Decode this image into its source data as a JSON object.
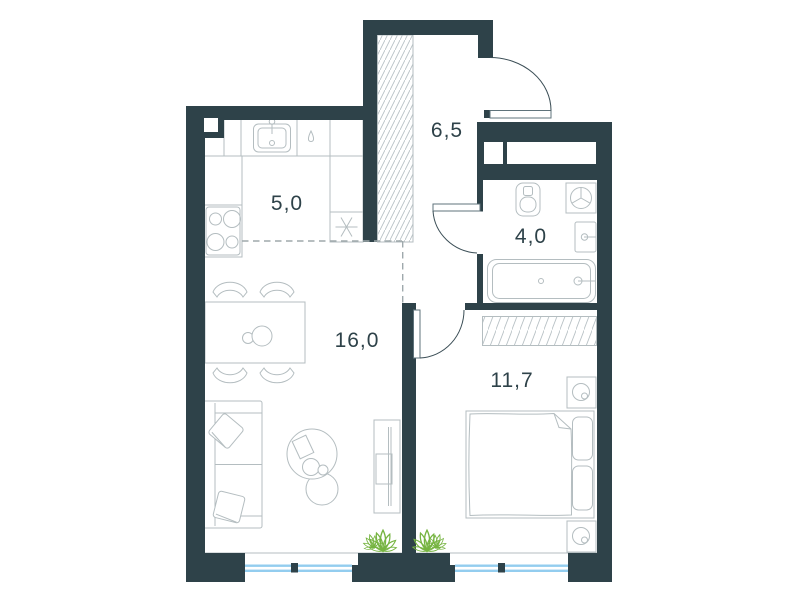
{
  "page": {
    "type": "apartment-floor-plan",
    "background": "#ffffff"
  },
  "rooms": [
    {
      "name": "kitchen",
      "area_label": "5,0"
    },
    {
      "name": "hallway",
      "area_label": "6,5"
    },
    {
      "name": "bathroom",
      "area_label": "4,0"
    },
    {
      "name": "living-room",
      "area_label": "16,0"
    },
    {
      "name": "bedroom",
      "area_label": "11,7"
    }
  ],
  "colors": {
    "wall": "#2e4249",
    "fixture_line": "#b4bdc0",
    "door_line": "#5f737b",
    "door_arc": "#3a4d55",
    "dashed_zone_line": "#9fa9ac",
    "window_glass": "#93cdef",
    "plant_green": "#76b441",
    "label_text": "#2e4249"
  },
  "icons": [
    "kitchen-sink-icon",
    "dishwasher-drop-icon",
    "fridge-snowflake-icon",
    "stove-icon",
    "ventilation-shaft-hatch",
    "toilet-icon",
    "washing-machine-icon",
    "bathroom-sink-icon",
    "bathtub-icon",
    "wardrobe-hatch",
    "dining-table-icon",
    "chair-icon",
    "sofa-icon",
    "coffee-table-icon",
    "tv-stand-icon",
    "bed-icon",
    "nightstand-lamp-icon",
    "plant-icon",
    "window-icon",
    "door-swing-icon"
  ]
}
